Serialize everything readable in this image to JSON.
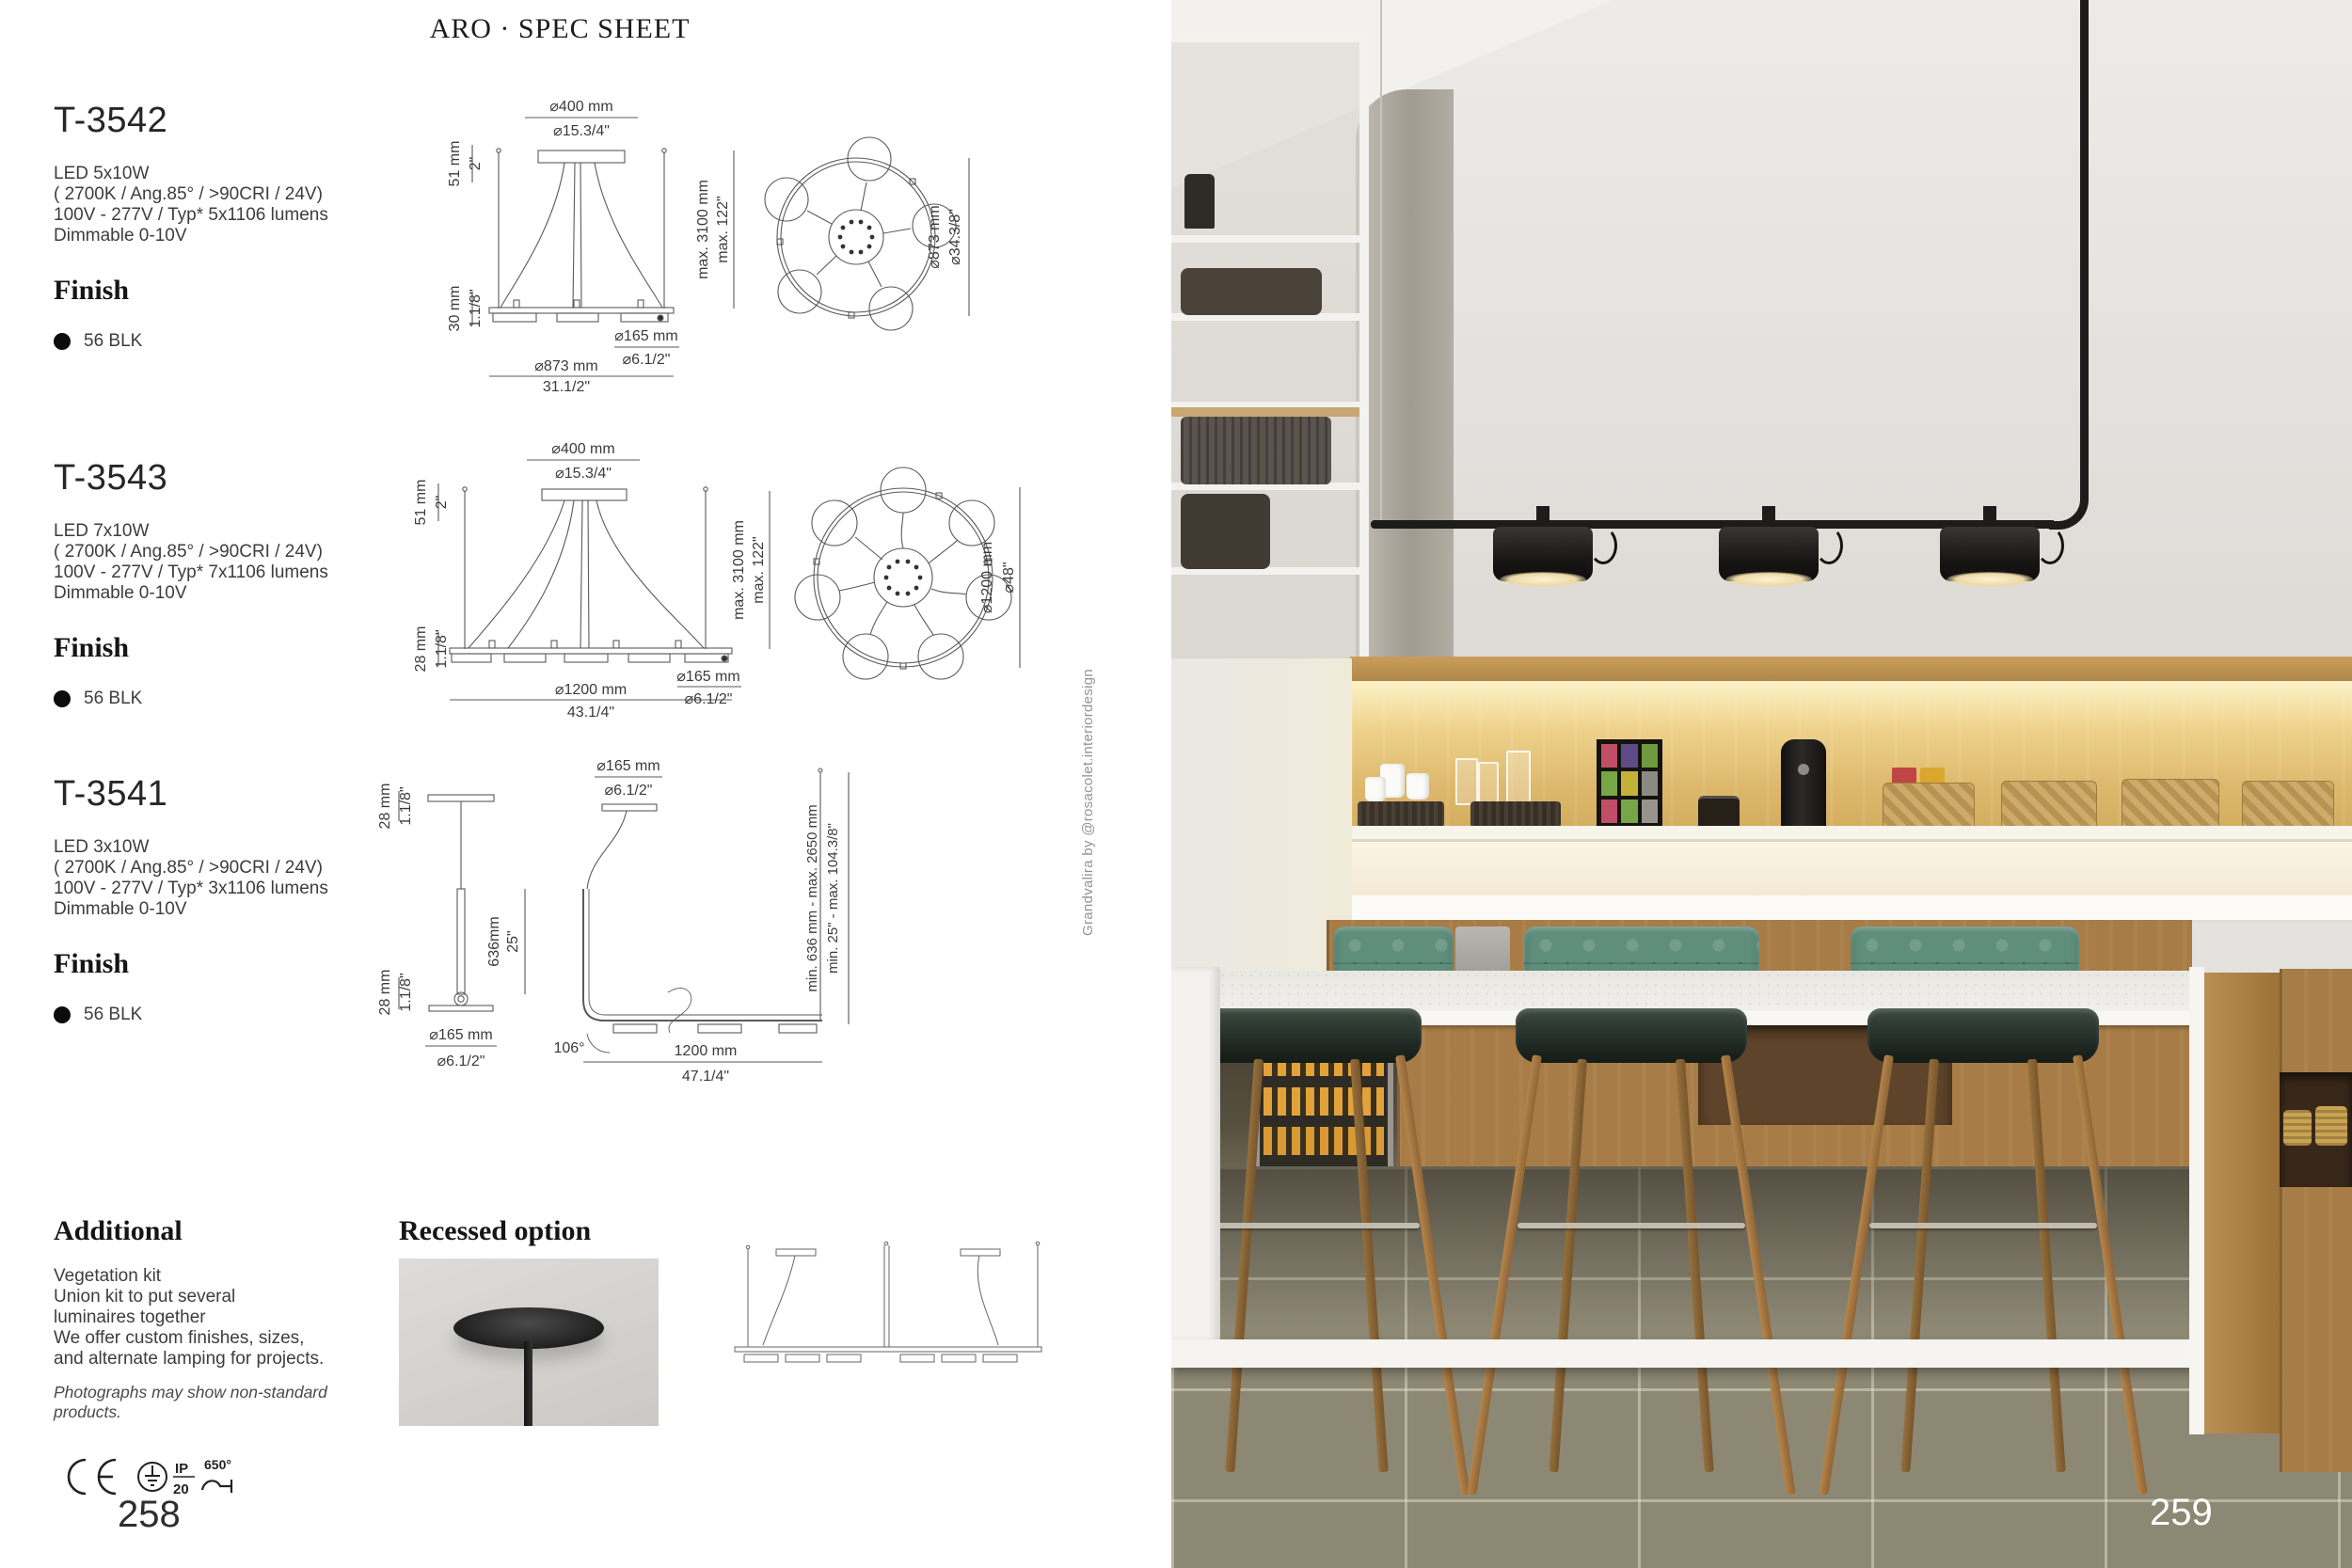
{
  "page": {
    "title": "ARO · SPEC SHEET",
    "left_page_number": "258",
    "right_page_number": "259",
    "photo_credit": "Grandvalira by @rosacolet.interiordesign"
  },
  "products": [
    {
      "model": "T-3542",
      "specs": [
        "LED 5x10W",
        "( 2700K / Ang.85° / >90CRI / 24V)",
        "100V - 277V / Typ* 5x1106 lumens",
        "Dimmable 0-10V"
      ],
      "finish_heading": "Finish",
      "finish_swatch": "56 BLK",
      "dims": {
        "canopy_mm": "⌀400 mm",
        "canopy_in": "⌀15.3/4\"",
        "canopy_h_mm": "51 mm",
        "canopy_h_in": "2\"",
        "body_h_mm": "30 mm",
        "body_h_in": "1.1/8\"",
        "drop_mm": "max. 3100 mm",
        "drop_in": "max. 122\"",
        "head_mm": "⌀165 mm",
        "head_in": "⌀6.1/2\"",
        "width_mm": "⌀873 mm",
        "width_in": "31.1/2\"",
        "plan_mm": "⌀873 mm",
        "plan_in": "⌀34.3/8\""
      }
    },
    {
      "model": "T-3543",
      "specs": [
        "LED 7x10W",
        "( 2700K / Ang.85° / >90CRI / 24V)",
        "100V - 277V / Typ* 7x1106 lumens",
        "Dimmable 0-10V"
      ],
      "finish_heading": "Finish",
      "finish_swatch": "56 BLK",
      "dims": {
        "canopy_mm": "⌀400 mm",
        "canopy_in": "⌀15.3/4\"",
        "canopy_h_mm": "51 mm",
        "canopy_h_in": "2\"",
        "body_h_mm": "28 mm",
        "body_h_in": "1.1/8\"",
        "drop_mm": "max. 3100 mm",
        "drop_in": "max. 122\"",
        "head_mm": "⌀165 mm",
        "head_in": "⌀6.1/2\"",
        "width_mm": "⌀1200 mm",
        "width_in": "43.1/4\"",
        "plan_mm": "⌀1200 mm",
        "plan_in": "⌀48\""
      }
    },
    {
      "model": "T-3541",
      "specs": [
        "LED 3x10W",
        "( 2700K / Ang.85° / >90CRI / 24V)",
        "100V - 277V / Typ* 3x1106 lumens",
        "Dimmable 0-10V"
      ],
      "finish_heading": "Finish",
      "finish_swatch": "56 BLK",
      "dims": {
        "canopy_h_mm": "28 mm",
        "canopy_h_in": "1.1/8\"",
        "stem_mm": "636mm",
        "stem_in": "25\"",
        "body_h_mm": "28 mm",
        "body_h_in": "1.1/8\"",
        "head_mm": "⌀165 mm",
        "head_in": "⌀6.1/2\"",
        "canopy_mm": "⌀165 mm",
        "canopy_in": "⌀6.1/2\"",
        "drop_mm": "min. 636 mm - max. 2650 mm",
        "drop_in": "min. 25\" - max. 104.3/8\"",
        "angle": "106°",
        "width_mm": "1200 mm",
        "width_in": "47.1/4\""
      }
    }
  ],
  "additional": {
    "heading": "Additional",
    "lines": [
      "Vegetation kit",
      "Union kit to put several",
      "luminaires together",
      "We offer custom finishes, sizes,",
      "and alternate lamping for projects."
    ],
    "note": "Photographs may show non-standard products."
  },
  "recessed": {
    "heading": "Recessed option"
  },
  "certifications": {
    "ip_top": "IP",
    "ip_bottom": "20",
    "glow_temp": "650°"
  },
  "colors": {
    "accent_black": "#0c0c0c",
    "wood": "#a87c46",
    "banquette_green": "#5f8e7c",
    "glow": "#f7ecc9"
  }
}
